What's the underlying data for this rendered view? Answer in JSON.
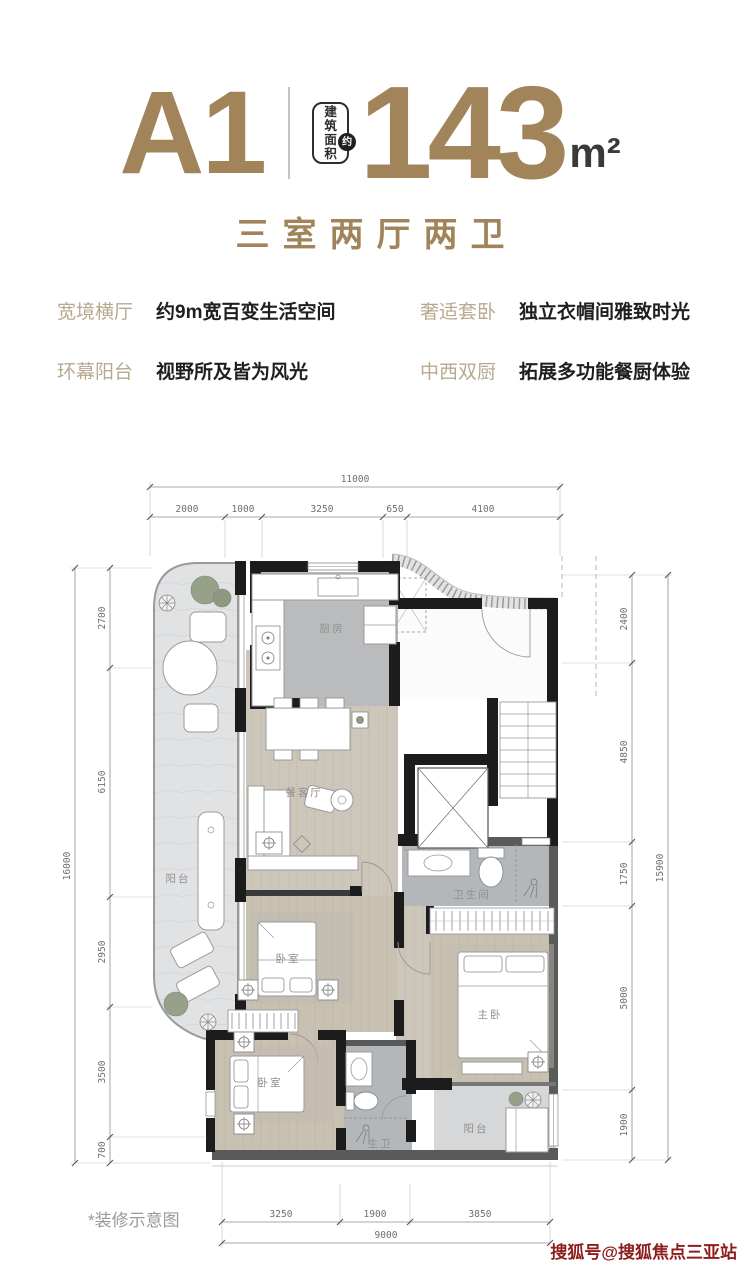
{
  "colors": {
    "accent_gold": "#a2845b",
    "feature_title_tan": "#b7a98f",
    "text_dark": "#1f1f1f",
    "note_gray": "#9a9a9a",
    "watermark_red": "#8e1c1c"
  },
  "header": {
    "unit_name": "A1",
    "area_badge_chars": [
      "建",
      "筑",
      "面",
      "积"
    ],
    "area_badge_circle": "约",
    "area_value": "143",
    "area_unit": "m²",
    "layout_type": "三室两厅两卫"
  },
  "features": [
    {
      "title": "宽境横厅",
      "desc": "约9m宽百变生活空间"
    },
    {
      "title": "奢适套卧",
      "desc": "独立衣帽间雅致时光"
    },
    {
      "title": "环幕阳台",
      "desc": "视野所及皆为风光"
    },
    {
      "title": "中西双厨",
      "desc": "拓展多功能餐厨体验"
    }
  ],
  "plan": {
    "rooms": {
      "balcony_left": "阳台",
      "kitchen": "厨房",
      "dining_living": "餐客厅",
      "bedroom_mid": "卧室",
      "bathroom": "卫生间",
      "master_bedroom": "主卧",
      "bedroom_second": "卧室",
      "master_bath": "主卫",
      "balcony_bottom": "阳台"
    },
    "dims": {
      "top": {
        "total": "11000",
        "segments": [
          "2000",
          "1000",
          "3250",
          "650",
          "4100"
        ]
      },
      "left": {
        "total": "16000",
        "segments": [
          "2700",
          "6150",
          "2950",
          "3500",
          "700"
        ]
      },
      "right": {
        "total": "15900",
        "segments": [
          "2400",
          "4850",
          "1750",
          "5000",
          "1900"
        ]
      },
      "bottom": {
        "total": "9000",
        "segments": [
          "3250",
          "1900",
          "3850"
        ]
      }
    }
  },
  "footer": {
    "note": "*装修示意图",
    "watermark": "搜狐号@搜狐焦点三亚站"
  }
}
